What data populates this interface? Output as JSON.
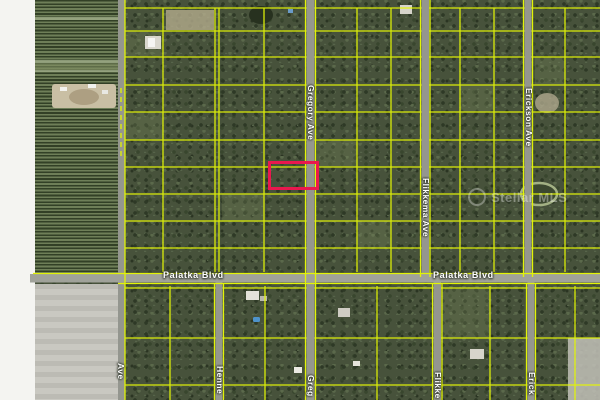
{
  "map": {
    "type": "aerial-parcel-map",
    "streets": {
      "gregory": "Gregory Ave",
      "flikkema": "Flikkema Ave",
      "erickson": "Erickson Ave",
      "palatka": "Palatka Blvd",
      "henne_cut": "Henne",
      "gregory_cut": "Greg",
      "flikkema_cut": "Flikke",
      "erickson_cut": "Erick",
      "left_ave_cut": "Ave"
    },
    "watermark": {
      "text": "Stellar MLS"
    },
    "highlight_parcel": {
      "x": 269,
      "y": 162,
      "width": 48,
      "height": 27,
      "outline_color": "#e9184e"
    },
    "colors": {
      "parcel_line": "#e2f407",
      "road": "#94968f",
      "trees": "#47523b",
      "farm": "#5a6b48",
      "bare_field": "#c6c5be",
      "label_text": "#ffffff"
    }
  }
}
